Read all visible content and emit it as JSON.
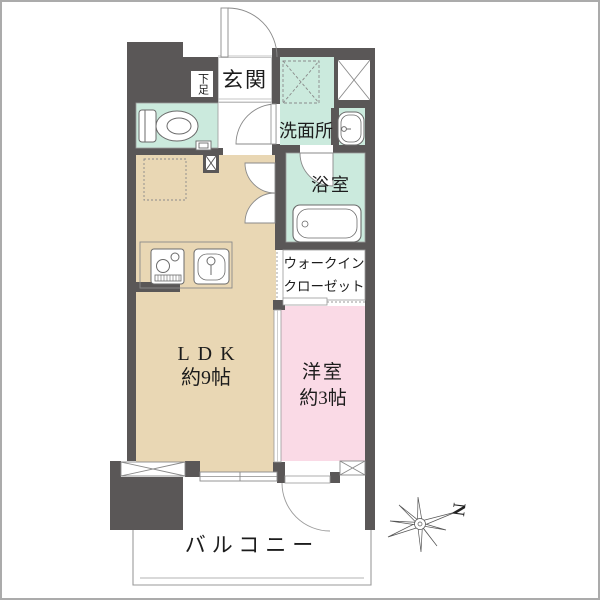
{
  "page": {
    "type": "japanese-apartment-floor-plan"
  },
  "rooms": {
    "genkan": {
      "label": "玄関"
    },
    "shoe_cabinet": {
      "label": "下足"
    },
    "washroom": {
      "label": "洗面所"
    },
    "bathroom": {
      "label": "浴室"
    },
    "walk_in_closet": {
      "line1": "ウォークイン",
      "line2": "クローゼット"
    },
    "ldk": {
      "label": "LDK",
      "size": "約9帖"
    },
    "western_room": {
      "label": "洋室",
      "size": "約3帖"
    },
    "balcony": {
      "label": "バルコニー"
    }
  },
  "compass": {
    "north": "N"
  },
  "colors": {
    "wall": "#5a5757",
    "ldk_floor": "#e9d7b4",
    "western_floor": "#fadae6",
    "wet_area_floor": "#cbeadd",
    "thin_line": "#8a8a8a",
    "frame": "#ababab"
  }
}
